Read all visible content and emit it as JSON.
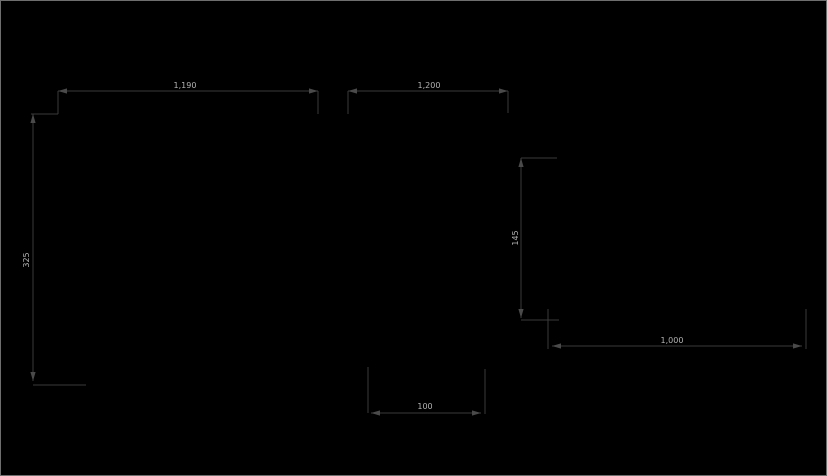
{
  "canvas": {
    "width": 827,
    "height": 476,
    "background": "#000000",
    "border_color": "#6e6e6e",
    "line_color": "#3a3a3a",
    "arrow_color": "#4a4a4a",
    "text_color": "#b3b3b3",
    "label_font_size": 8
  },
  "drawing": {
    "type": "cad-dimension-drawing",
    "description": "Technical drawing canvas showing dimension lines only",
    "dimensions": [
      {
        "name": "dim-top-left-width",
        "label": "1,190",
        "orientation": "horizontal",
        "line": {
          "x1": 57,
          "y1": 90,
          "x2": 317,
          "y2": 90
        },
        "arrows": [
          {
            "x": 57,
            "y": 90,
            "dir": "left"
          },
          {
            "x": 317,
            "y": 90,
            "dir": "right"
          }
        ],
        "extensions": [
          {
            "x1": 57,
            "y1": 90,
            "x2": 57,
            "y2": 113
          },
          {
            "x1": 317,
            "y1": 90,
            "x2": 317,
            "y2": 113
          }
        ],
        "label_pos": {
          "x": 184,
          "y": 87
        },
        "label_rotation": 0
      },
      {
        "name": "dim-top-right-width",
        "label": "1,200",
        "orientation": "horizontal",
        "line": {
          "x1": 347,
          "y1": 90,
          "x2": 507,
          "y2": 90
        },
        "arrows": [
          {
            "x": 347,
            "y": 90,
            "dir": "left"
          },
          {
            "x": 507,
            "y": 90,
            "dir": "right"
          }
        ],
        "extensions": [
          {
            "x1": 347,
            "y1": 90,
            "x2": 347,
            "y2": 113
          },
          {
            "x1": 507,
            "y1": 90,
            "x2": 507,
            "y2": 112
          }
        ],
        "label_pos": {
          "x": 428,
          "y": 87
        },
        "label_rotation": 0
      },
      {
        "name": "dim-left-height",
        "label": "325",
        "orientation": "vertical",
        "line": {
          "x1": 32,
          "y1": 113,
          "x2": 32,
          "y2": 380
        },
        "arrows": [
          {
            "x": 32,
            "y": 113,
            "dir": "up"
          },
          {
            "x": 32,
            "y": 380,
            "dir": "down"
          }
        ],
        "extensions": [
          {
            "x1": 30,
            "y1": 113,
            "x2": 57,
            "y2": 113
          },
          {
            "x1": 32,
            "y1": 384,
            "x2": 85,
            "y2": 384
          }
        ],
        "label_pos": {
          "x": 28,
          "y": 259
        },
        "label_rotation": -90
      },
      {
        "name": "dim-mid-right-height",
        "label": "145",
        "orientation": "vertical",
        "line": {
          "x1": 520,
          "y1": 157,
          "x2": 520,
          "y2": 317
        },
        "arrows": [
          {
            "x": 520,
            "y": 157,
            "dir": "up"
          },
          {
            "x": 520,
            "y": 317,
            "dir": "down"
          }
        ],
        "extensions": [
          {
            "x1": 520,
            "y1": 157,
            "x2": 556,
            "y2": 157
          },
          {
            "x1": 520,
            "y1": 319,
            "x2": 558,
            "y2": 319
          }
        ],
        "label_pos": {
          "x": 517,
          "y": 237
        },
        "label_rotation": -90
      },
      {
        "name": "dim-bottom-right-width",
        "label": "1,000",
        "orientation": "horizontal",
        "line": {
          "x1": 551,
          "y1": 345,
          "x2": 801,
          "y2": 345
        },
        "arrows": [
          {
            "x": 551,
            "y": 345,
            "dir": "left"
          },
          {
            "x": 801,
            "y": 345,
            "dir": "right"
          }
        ],
        "extensions": [
          {
            "x1": 547,
            "y1": 308,
            "x2": 547,
            "y2": 348
          },
          {
            "x1": 805,
            "y1": 308,
            "x2": 805,
            "y2": 348
          }
        ],
        "label_pos": {
          "x": 671,
          "y": 342
        },
        "label_rotation": 0
      },
      {
        "name": "dim-bottom-width",
        "label": "100",
        "orientation": "horizontal",
        "line": {
          "x1": 370,
          "y1": 412,
          "x2": 480,
          "y2": 412
        },
        "arrows": [
          {
            "x": 370,
            "y": 412,
            "dir": "left"
          },
          {
            "x": 480,
            "y": 412,
            "dir": "right"
          }
        ],
        "extensions": [
          {
            "x1": 367,
            "y1": 366,
            "x2": 367,
            "y2": 412
          },
          {
            "x1": 484,
            "y1": 368,
            "x2": 484,
            "y2": 413
          }
        ],
        "label_pos": {
          "x": 424,
          "y": 408
        },
        "label_rotation": 0
      }
    ]
  }
}
